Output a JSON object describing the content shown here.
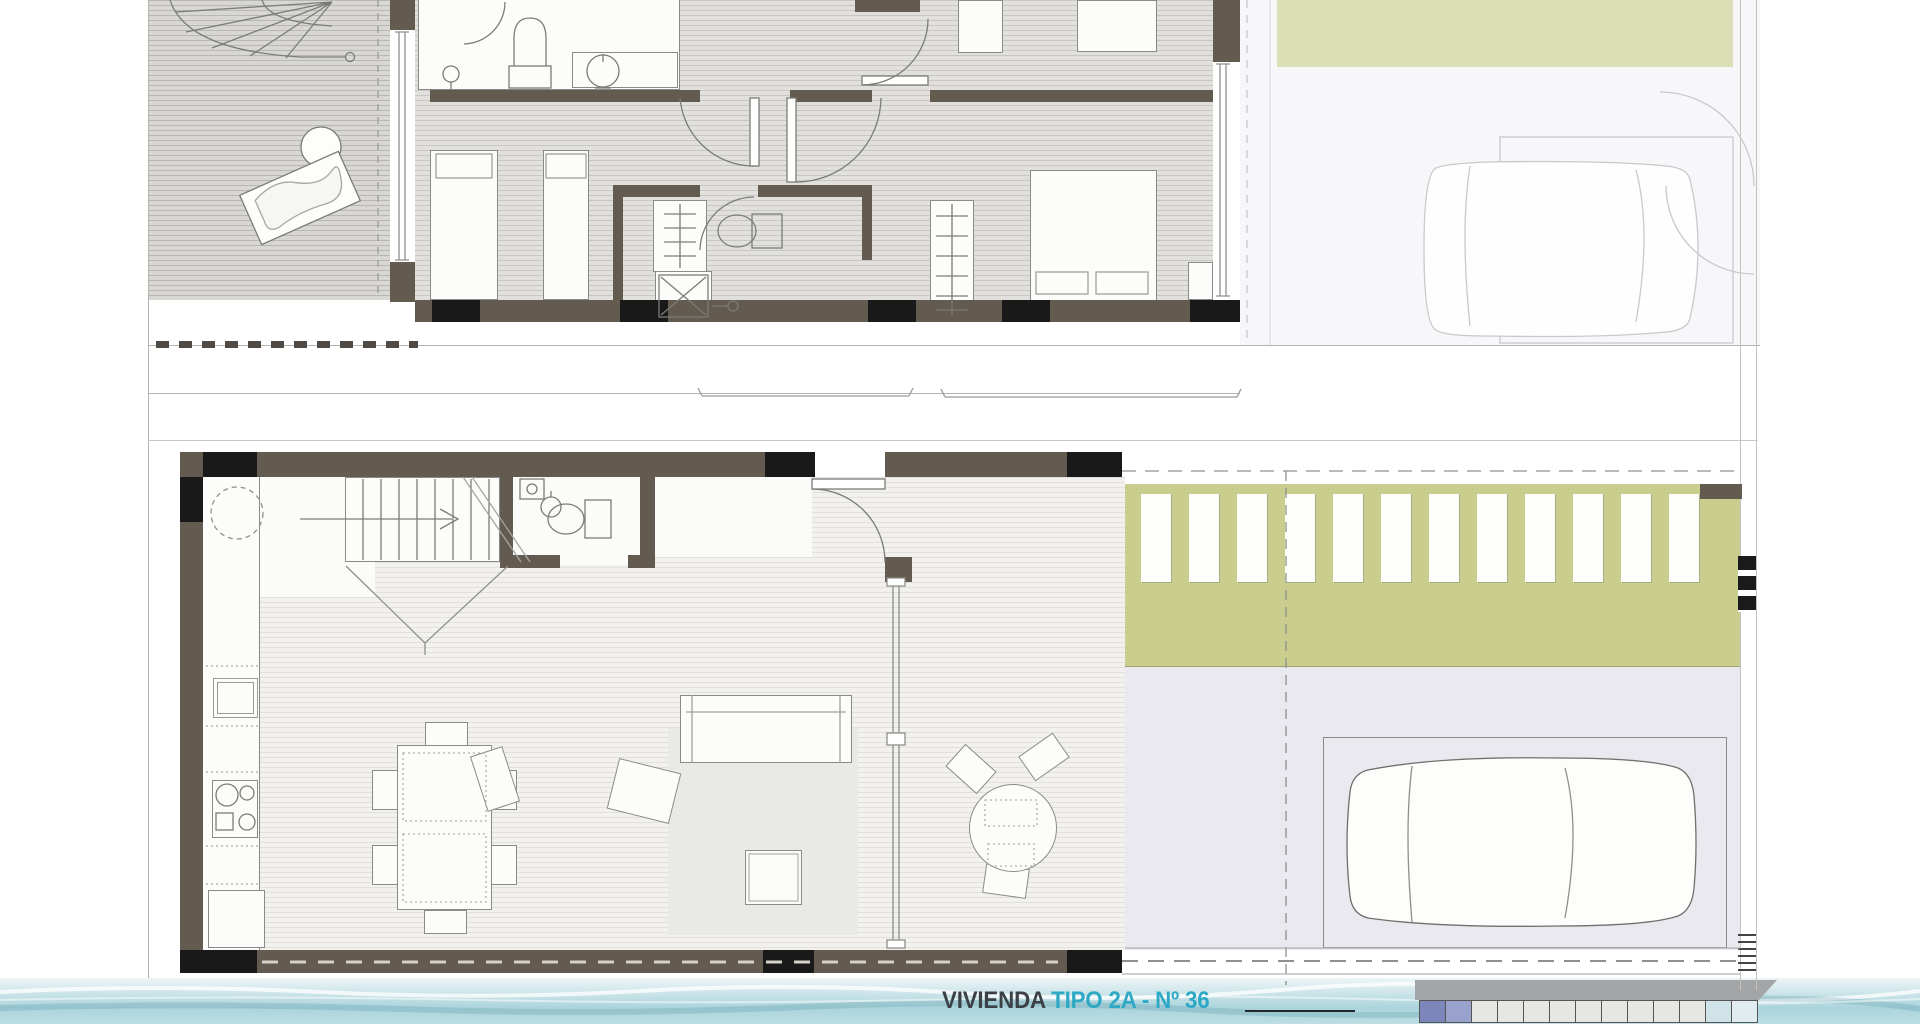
{
  "footer": {
    "dwelling_label": "VIVIENDA",
    "type_label": "TIPO 2A - Nº 36",
    "accent_color": "#2ea9c5",
    "label_color": "#3b4146"
  },
  "palette": {
    "wall": "#635b50",
    "pier": "#191919",
    "terrace_floor": "#d8d7d4",
    "interior_floor_upper": "#e1e0dc",
    "interior_floor_ground": "#f2f1ed",
    "garden": "#c9cd8e",
    "garden_faded": "#dcdeb6",
    "parking": "#e9e9ef",
    "linework": "#7b7b77",
    "faded_linework": "#c9c9cd",
    "water_top": "#edf6f7",
    "water_bottom": "#abd4dc"
  },
  "plans": {
    "upper": {
      "label": "first-floor-plan"
    },
    "ground": {
      "label": "ground-floor-plan"
    }
  }
}
